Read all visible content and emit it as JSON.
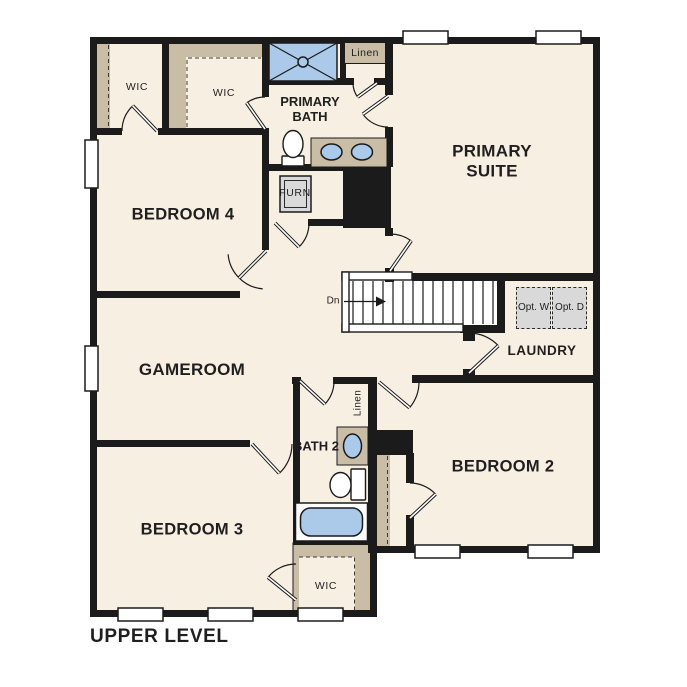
{
  "title": "UPPER LEVEL",
  "rooms": {
    "primary_suite": "PRIMARY SUITE",
    "primary_bath": "PRIMARY BATH",
    "bedroom2": "BEDROOM 2",
    "bedroom3": "BEDROOM 3",
    "bedroom4": "BEDROOM 4",
    "gameroom": "GAMEROOM",
    "laundry": "LAUNDRY",
    "bath2": "BATH 2",
    "wic_left": "WIC",
    "wic_mid": "WIC",
    "wic_bed3": "WIC",
    "linen_top": "Linen",
    "linen_bath2": "Linen",
    "furnace": "FURN"
  },
  "annotations": {
    "stairs_direction": "Dn",
    "opt_washer": "Opt. W",
    "opt_dryer": "Opt. D"
  },
  "colors": {
    "floor": "#f8efe3",
    "wall": "#1b1b1b",
    "casework": "#c9bda6",
    "fixture": "#abc9e8",
    "appliance": "#d9d9d9",
    "window": "#ffffff",
    "text": "#1f1f1f"
  }
}
